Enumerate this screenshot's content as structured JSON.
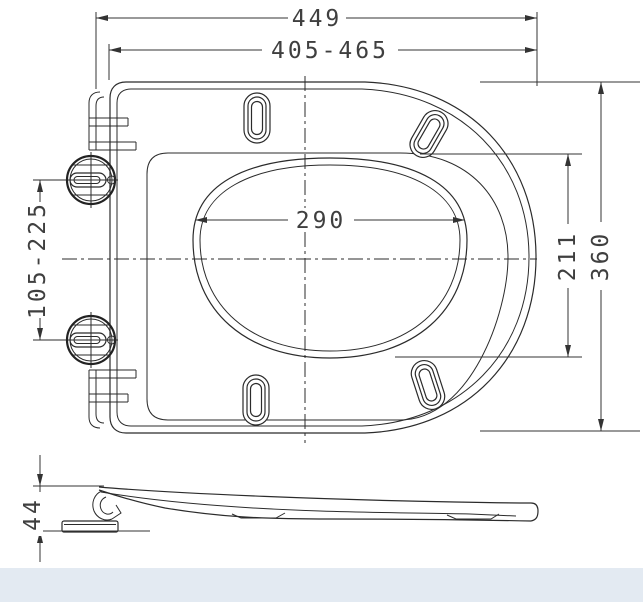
{
  "drawing": {
    "dimensions": {
      "overall_width": "449",
      "installation_range": "405-465",
      "opening_width": "290",
      "opening_length": "211",
      "overall_depth": "360",
      "hinge_hole_range": "105-225",
      "seat_height": "44"
    },
    "colors": {
      "line": "#2b2b2b",
      "dim_text": "#3f3f3f",
      "background": "#ffffff",
      "footer_band": "#e3eaf2"
    }
  }
}
